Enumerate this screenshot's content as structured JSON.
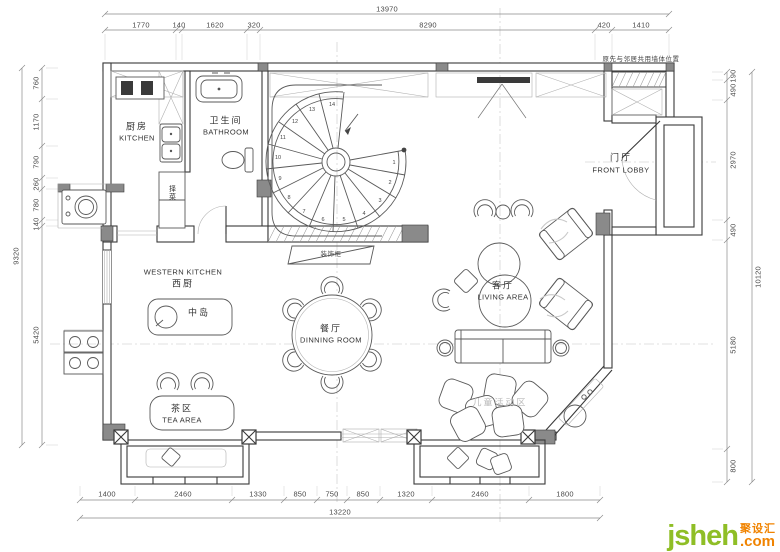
{
  "note": {
    "shared_wall": "原先与邻居共用墙体位置"
  },
  "rooms": {
    "kitchen": {
      "zh": "厨房",
      "en": "KITCHEN"
    },
    "bathroom": {
      "zh": "卫生间",
      "en": "BATHROOM"
    },
    "front_lobby": {
      "zh": "门厅",
      "en": "FRONT LOBBY"
    },
    "western_kitchen": {
      "en": "WESTERN KITCHEN",
      "zh": "西厨"
    },
    "island": {
      "zh": "中岛"
    },
    "dining_room": {
      "zh": "餐厅",
      "en": "DINNING ROOM"
    },
    "living_area": {
      "zh": "客厅",
      "en": "LIVING AREA"
    },
    "tea_area": {
      "zh": "茶区",
      "en": "TEA AREA"
    },
    "kids_area": {
      "zh": "儿童活动区"
    },
    "deco_cabinet": {
      "zh": "装饰柜"
    },
    "prep_cabinet": {
      "zh": "择菜"
    }
  },
  "dimensions": {
    "top": {
      "total": "13970",
      "segments": [
        "1770",
        "140",
        "1620",
        "320",
        "8290",
        "420",
        "1410"
      ]
    },
    "bottom": {
      "total": "13220",
      "segments": [
        "1400",
        "2460",
        "1330",
        "850",
        "750",
        "850",
        "1320",
        "2460",
        "1800"
      ]
    },
    "left": {
      "total": "9320",
      "segments": [
        "760",
        "1170",
        "790",
        "260",
        "780",
        "140",
        "5420"
      ]
    },
    "right": {
      "total": "10120",
      "segments": [
        "190",
        "490",
        "2970",
        "490",
        "5180",
        "800"
      ]
    }
  },
  "staircase": {
    "steps": [
      "1",
      "2",
      "3",
      "4",
      "5",
      "6",
      "7",
      "8",
      "9",
      "10",
      "11",
      "12",
      "13",
      "14"
    ]
  },
  "logo": {
    "brand": "jsheh",
    "tld": ".com",
    "zh": "聚设汇"
  },
  "colors": {
    "logo_green": "#8fbe26",
    "logo_orange": "#f08300",
    "line": "#3a3a3a",
    "dim_text": "#4a4a4a"
  }
}
